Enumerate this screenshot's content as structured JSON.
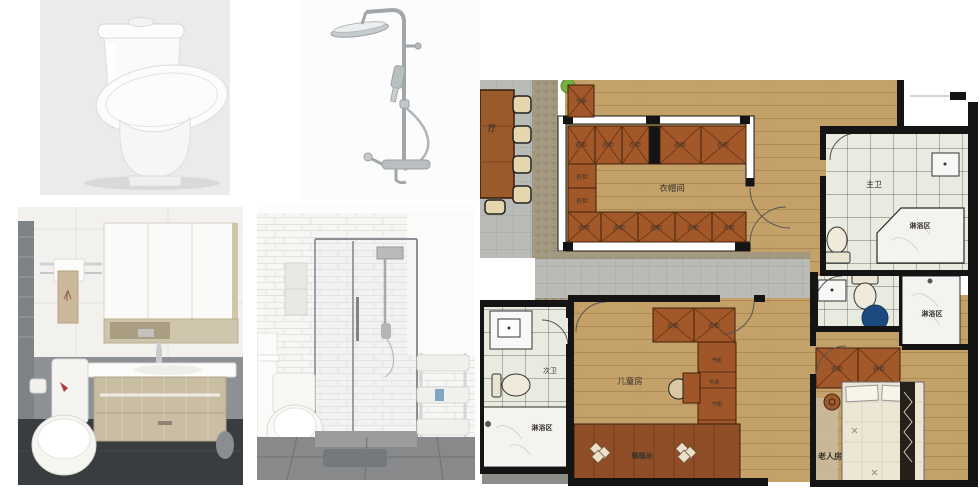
{
  "floorplan": {
    "labels": {
      "hall": "厅",
      "bookshelf": "书架",
      "wardrobe": "衣柜",
      "cloakroom": "衣帽间",
      "master_bath": "主卫",
      "shower_area": "淋浴区",
      "second_bath": "次卫",
      "kids_room": "儿童房",
      "bookcase": "书柜",
      "desk": "书桌",
      "tatami": "榻榻米",
      "elder_room": "老人房"
    },
    "colors": {
      "wood": "#c4a169",
      "cabinet": "#a3582a",
      "corridor_tile": "#b9bbb6",
      "bath_tile": "#e9ebe1",
      "marble": "#f3f3f0",
      "tatami_wood": "#8f4e27",
      "wall": "#141414",
      "marker_blue": "#1c4a7e",
      "plant_green": "#76b043"
    }
  }
}
